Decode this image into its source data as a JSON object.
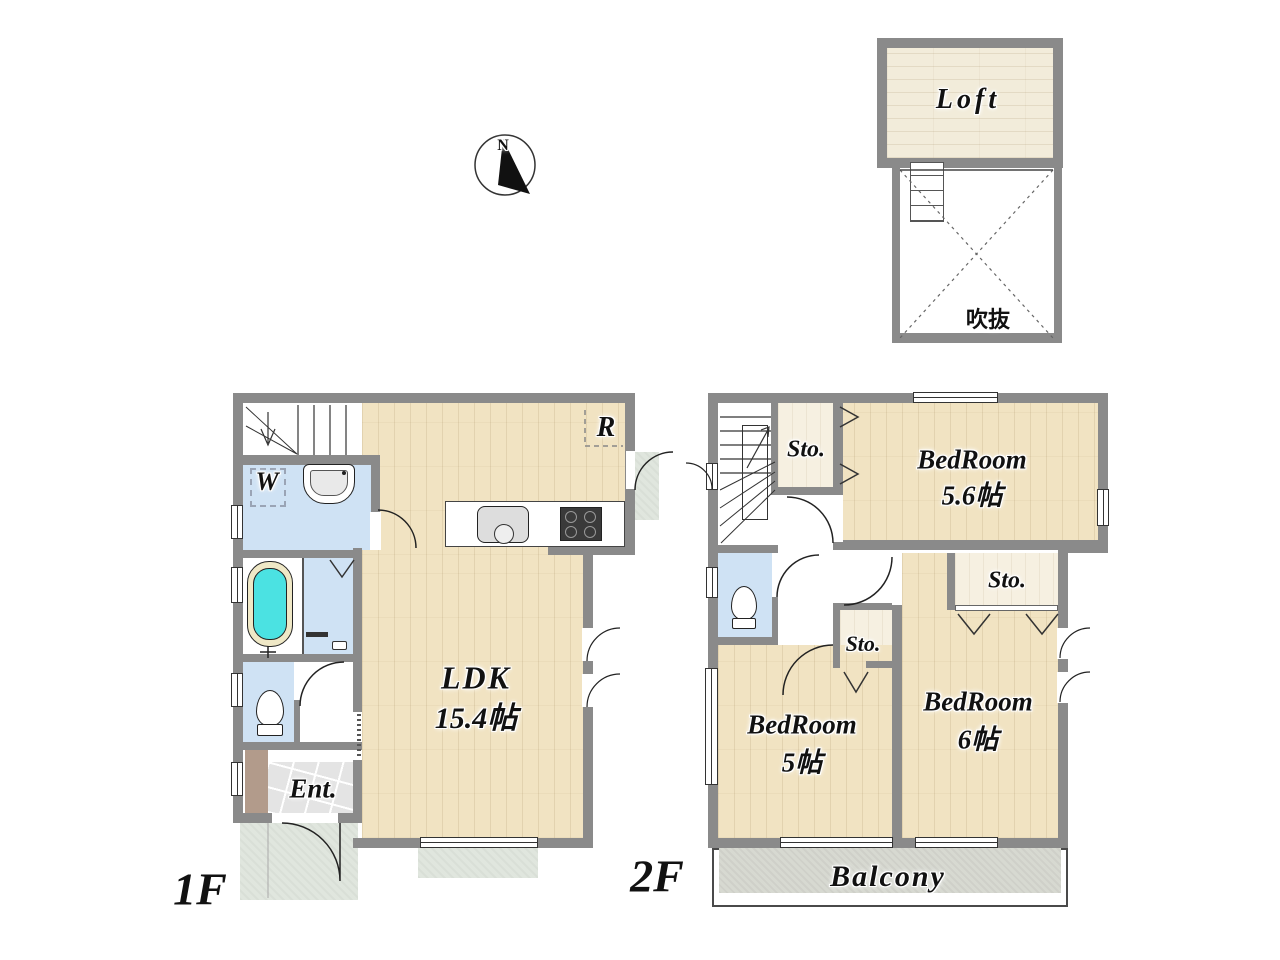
{
  "compass": {
    "north_label": "N"
  },
  "loft_plan": {
    "loft_label": "Loft",
    "void_label": "吹抜"
  },
  "floor_1": {
    "floor_label": "1F",
    "ldk_name": "LDK",
    "ldk_size": "15.4帖",
    "washroom_label": "W",
    "refrigerator_label": "R",
    "entrance_label": "Ent."
  },
  "floor_2": {
    "floor_label": "2F",
    "bedroom1_name": "BedRoom",
    "bedroom1_size": "5.6帖",
    "bedroom2_name": "BedRoom",
    "bedroom2_size": "5帖",
    "bedroom3_name": "BedRoom",
    "bedroom3_size": "6帖",
    "storage1_label": "Sto.",
    "storage2_label": "Sto.",
    "storage3_label": "Sto.",
    "balcony_label": "Balcony"
  },
  "colors": {
    "wall": "#8a8a8a",
    "wood_floor": "#f1e3c2",
    "wet_area_blue": "#cfe2f4",
    "bathtub_cyan": "#4be2e2",
    "storage_floor": "#f6f0e1",
    "loft_floor": "#f2ecda",
    "balcony_concrete": "#d7d9d1",
    "porch_green": "#e0e6de",
    "shoe_cabinet_brown": "#b29b8b",
    "entrance_tile": "#e4e4e4"
  }
}
